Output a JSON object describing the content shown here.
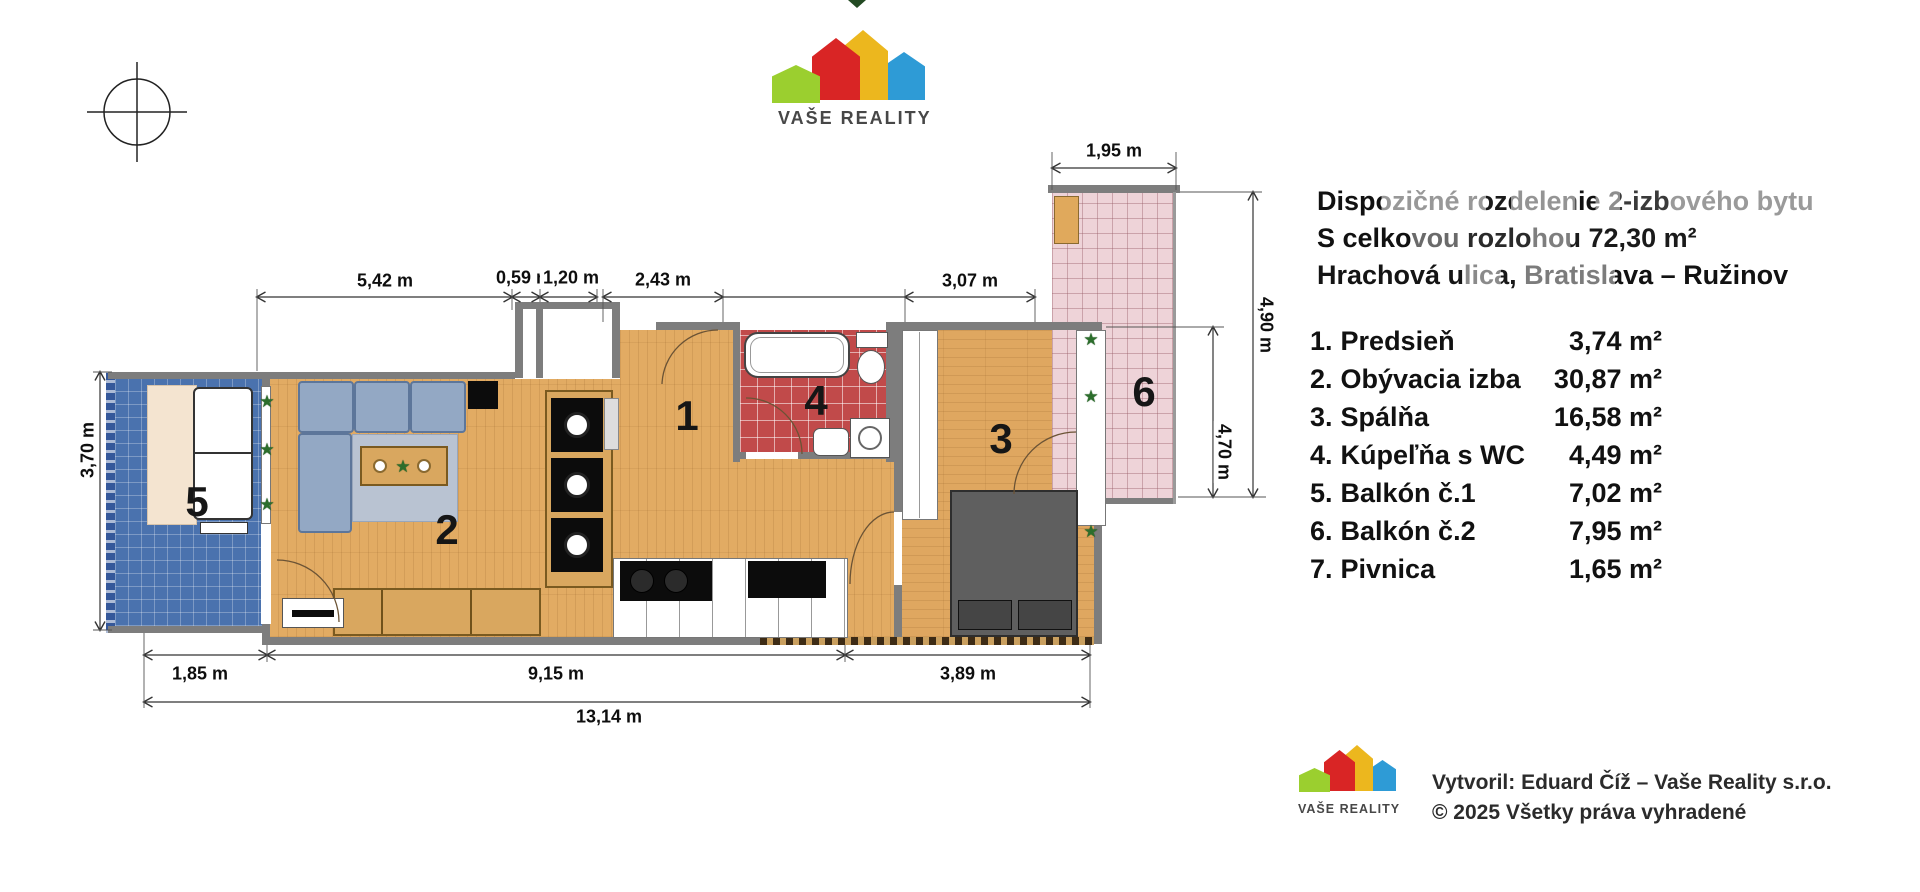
{
  "brand": {
    "name": "VAŠE REALITY"
  },
  "title_block": {
    "line1": "Dispozičné rozdelenie 2-izbového bytu",
    "line2": "S celkovou rozlohou 72,30 m²",
    "line3": "Hrachová ulica, Bratislava – Ružinov"
  },
  "legend": {
    "rooms": [
      {
        "num": "1.",
        "name": "Predsieň",
        "area": "3,74 m²"
      },
      {
        "num": "2.",
        "name": "Obývacia izba",
        "area": "30,87 m²"
      },
      {
        "num": "3.",
        "name": "Spálňa",
        "area": "16,58 m²"
      },
      {
        "num": "4.",
        "name": "Kúpeľňa s WC",
        "area": "4,49 m²"
      },
      {
        "num": "5.",
        "name": "Balkón č.1",
        "area": "7,02 m²"
      },
      {
        "num": "6.",
        "name": "Balkón č.2",
        "area": "7,95 m²"
      },
      {
        "num": "7.",
        "name": "Pivnica",
        "area": "1,65 m²"
      }
    ]
  },
  "plan": {
    "room_labels": {
      "r1": "1",
      "r2": "2",
      "r3": "3",
      "r4": "4",
      "r5": "5",
      "r6": "6"
    },
    "plant_glyph": "★",
    "dimensions": {
      "d542": "5,42 m",
      "d059": "0,59 m",
      "d120": "1,20 m",
      "d243": "2,43 m",
      "d307": "3,07 m",
      "d195": "1,95 m",
      "d370": "3,70 m",
      "d490": "4,90 m",
      "d470": "4,70 m",
      "d185": "1,85 m",
      "d915": "9,15 m",
      "d389": "3,89 m",
      "d1314": "13,14 m"
    }
  },
  "footer": {
    "brand": "VAŠE REALITY",
    "credit_line1": "Vytvoril: Eduard Číž – Vaše Reality s.r.o.",
    "credit_line2": "© 2025 Všetky práva vyhradené"
  },
  "colors": {
    "wall": "#7d7d7d",
    "wood_floor": "#e2ab63",
    "bath_tile": "#c14a4a",
    "balcony1_tile": "#4a72ae",
    "balcony2_tile": "#eed3d8",
    "logo_green": "#9bcf2f",
    "logo_red": "#d92525",
    "logo_yellow": "#ecb71e",
    "logo_blue": "#2e9bd6"
  }
}
